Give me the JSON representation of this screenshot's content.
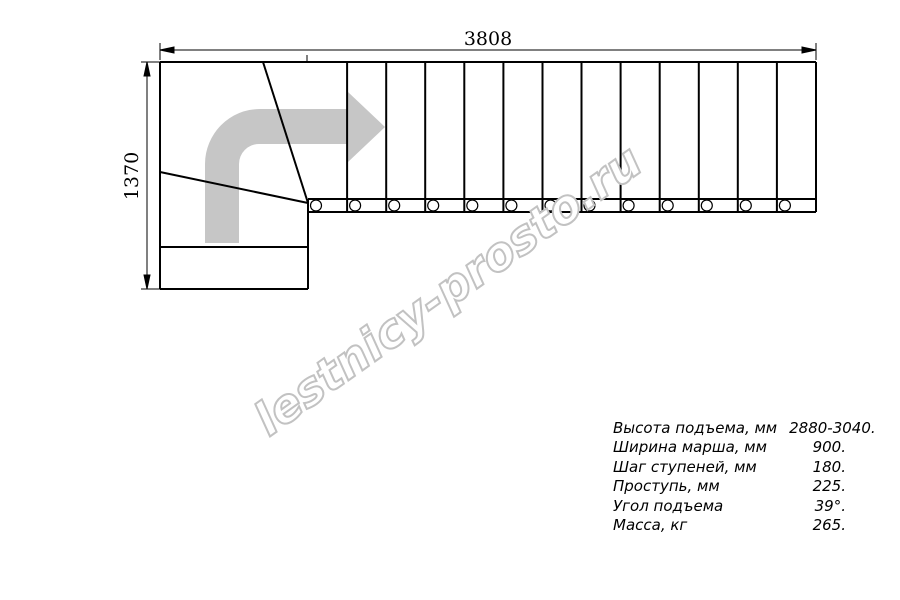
{
  "watermark": {
    "text": "lestnicy-prosto.ru",
    "color": "#c2c2c2"
  },
  "drawing": {
    "title": "stair-plan-top-view",
    "total_length_label": "3808",
    "total_width_label": "1370",
    "straight_treads": 13,
    "arrow_color": "#c6c6c6",
    "line_color": "#000000"
  },
  "specs": {
    "rows": [
      {
        "label": "Высота подъема, мм",
        "value": "2880-3040."
      },
      {
        "label": "Ширина марша, мм",
        "value": "900."
      },
      {
        "label": "Шаг ступеней, мм",
        "value": "180."
      },
      {
        "label": "Проступь, мм",
        "value": "225."
      },
      {
        "label": "Угол подъема",
        "value": "39°."
      },
      {
        "label": "Масса, кг",
        "value": "265."
      }
    ]
  }
}
